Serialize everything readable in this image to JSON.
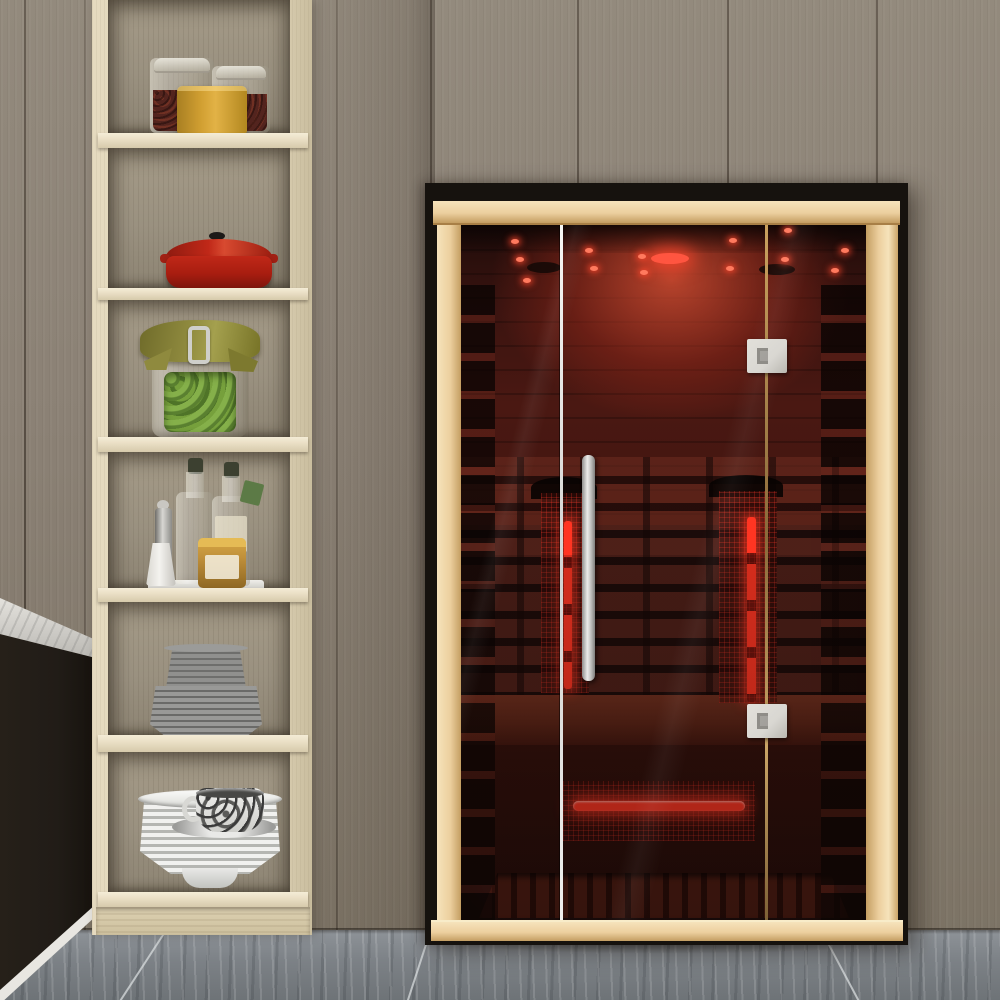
{
  "scene": {
    "description": "Showroom photo of a two-person infrared sauna cabin with tinted glass front standing against a taupe wood-plank wall, next to a tall light-wood open shelf unit filled with kitchenware, above a grey marble tile floor",
    "room": "interior showroom",
    "no_visible_text": true
  },
  "colors": {
    "wall": "#8b8175",
    "wall_seam": "#4f483e",
    "floor": "#8e9398",
    "floor_dark": "#6e7377",
    "grout": "#d8dcde",
    "marble": "#e9e7e2",
    "marble_shadow": "#b9b7b2",
    "cabinet": "#211c17",
    "baseboard": "#e8e6e1",
    "shelf_frame": "#e5dabf",
    "shelf_frame_dark": "#c9bd9e",
    "shelf_back": "#9a9180",
    "shelf_board": "#ece1c8",
    "sauna_black": "#16120e",
    "beech": "#eccf9e",
    "beech_light": "#f6e3bb",
    "beech_dark": "#c49e62",
    "glass_dark": "#241010",
    "glow": "#b5402a",
    "glow_bright": "#e05a3c",
    "heater_red": "#ff3522",
    "led": "#ff7a5e",
    "metal": "#d9d7d2",
    "metal_dark": "#8f8d88",
    "pot_red": "#c02818",
    "pot_dark": "#7e150c",
    "canister": "#d2a032",
    "beans": "#53241e",
    "olive_green": "#7aa23f",
    "fabric_olive": "#8f8a3e",
    "bottle_glass": "#d9d5c4",
    "bottle_cap": "#3c4030",
    "honey": "#bf8f3a",
    "plate_gray": "#90908e",
    "plate_gray_dark": "#6e6e6c",
    "plate_white": "#f1f1ef",
    "plate_white_dark": "#b5b6b2",
    "cup_dark": "#3a3a3a"
  },
  "objects": {
    "wall": {
      "label": "taupe vertical wood plank wall"
    },
    "floor": {
      "label": "grey marble tile floor"
    },
    "counter": {
      "label": "dark cabinet with white marble countertop, far left"
    },
    "shelf": {
      "label": "tall light-wood open shelving unit",
      "compartments": [
        {
          "name": "top",
          "items": [
            "glass storage jar with dried beans",
            "glass storage jar with dried beans",
            "mustard-yellow canister"
          ]
        },
        {
          "name": "second",
          "items": [
            "red enameled dutch oven with black knob"
          ]
        },
        {
          "name": "third",
          "items": [
            "bail-clasp preserving jar of green olives with olive cloth cover"
          ]
        },
        {
          "name": "fourth",
          "items": [
            "two oil bottles with dark caps",
            "steel pepper grinder",
            "white shaker",
            "amber honey jar",
            "white tray"
          ]
        },
        {
          "name": "fifth",
          "items": [
            "stack of grey bowls",
            "stack of grey plates"
          ]
        },
        {
          "name": "bottom",
          "items": [
            "stack of white plates",
            "black-and-white patterned teacup on saucer"
          ]
        }
      ]
    },
    "sauna": {
      "label": "infrared sauna cabin with tinted glass front",
      "features": [
        "black outer casing",
        "light beech wood frame",
        "three glass front panels",
        "center glass door with long vertical metal handle",
        "two door hinges on right divider",
        "red ceiling spot lights and round ceiling lamp",
        "two vertical infrared heater panels glowing red",
        "horizontal red floor-level heater with protective mesh",
        "interior bench and slatted duckboard floor"
      ]
    }
  }
}
